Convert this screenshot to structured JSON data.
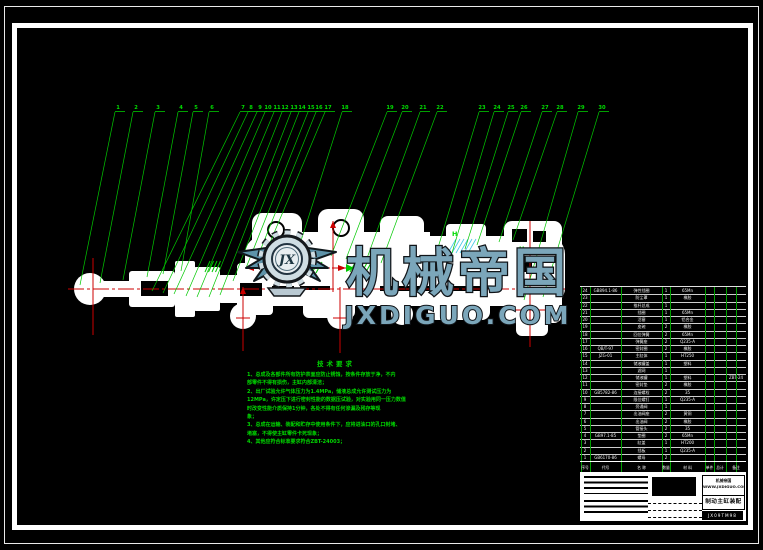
{
  "colors": {
    "line_green": "#00c800",
    "text_green": "#00d800",
    "centerline_red": "#cc0000",
    "hatch_cyan": "#45c8e6",
    "table_green": "#00a000",
    "watermark_fill": "#7ba6ba",
    "watermark_outline": "#101418",
    "drawing_white": "#ffffff"
  },
  "watermark": {
    "brand": "机械帝国",
    "site": "JXDIGUO.COM",
    "monogram": "JX"
  },
  "balloons": {
    "labels": [
      "1",
      "2",
      "3",
      "4",
      "5",
      "6",
      "7",
      "8",
      "9",
      "10",
      "11",
      "12",
      "13",
      "14",
      "15",
      "16",
      "17",
      "18",
      "19",
      "20",
      "21",
      "22",
      "23",
      "24",
      "25",
      "26",
      "27",
      "28",
      "29",
      "30"
    ]
  },
  "section_labels": [
    "H",
    "H"
  ],
  "notes": {
    "title": "技术要求",
    "lines": [
      "1、总成及各部件所有防护表面应防止锈蚀，按条件存放于净，不内",
      "部零件不得有损伤，主缸内部清洁；",
      "2、出厂试验允许气体压力为1.4MPa，储液总成允许测试压力为",
      "12MPa，许定压下进行密封性能的数据压试验，对实验用同一压力数值",
      "时改变性能介质保持1分钟，各处不得有任何渗漏及残存等现",
      "象；",
      "3、总成在运输、装配和贮存中使用条件下，应将进油口的孔口封堵、",
      "堵塞，不得使主缸零件卡死现象；",
      "4、其他应符合标准要求符合ZBT-24003；"
    ]
  },
  "bom": {
    "headers": [
      "序号",
      "代号",
      "名  称",
      "数量",
      "材  料",
      "单件",
      "总计",
      "备注"
    ],
    "rows": [
      [
        "24",
        "GB894.1-86",
        "弹性挡圈",
        "1",
        "65Mn",
        ""
      ],
      [
        "23",
        "",
        "防尘罩",
        "1",
        "橡胶",
        ""
      ],
      [
        "22",
        "",
        "推杆总成",
        "1",
        "",
        ""
      ],
      [
        "21",
        "",
        "挡圈",
        "1",
        "65Mn",
        ""
      ],
      [
        "20",
        "",
        "活塞",
        "1",
        "铝合金",
        ""
      ],
      [
        "19",
        "",
        "皮碗",
        "2",
        "橡胶",
        ""
      ],
      [
        "18",
        "",
        "回位弹簧",
        "2",
        "65Mn",
        ""
      ],
      [
        "17",
        "",
        "弹簧座",
        "2",
        "Q235-A",
        ""
      ],
      [
        "16",
        "QB/T-97",
        "密封圈",
        "2",
        "橡胶",
        ""
      ],
      [
        "15",
        "JZG-01",
        "主缸体",
        "1",
        "HT250",
        ""
      ],
      [
        "14",
        "",
        "储液罐盖",
        "1",
        "塑料",
        ""
      ],
      [
        "13",
        "",
        "滤网",
        "1",
        "",
        ""
      ],
      [
        "12",
        "",
        "储液罐",
        "1",
        "塑料",
        "ZBT-24"
      ],
      [
        "11",
        "",
        "密封垫",
        "2",
        "橡胶",
        ""
      ],
      [
        "10",
        "GB5782-86",
        "连接螺栓",
        "2",
        "35",
        ""
      ],
      [
        "9",
        "",
        "限位螺钉",
        "1",
        "Q235-A",
        ""
      ],
      [
        "8",
        "",
        "旁通阀",
        "1",
        "",
        ""
      ],
      [
        "7",
        "",
        "出油阀座",
        "2",
        "黄铜",
        ""
      ],
      [
        "6",
        "",
        "出油阀",
        "2",
        "橡胶",
        ""
      ],
      [
        "5",
        "",
        "管接头",
        "2",
        "35",
        ""
      ],
      [
        "4",
        "GB97.1-85",
        "垫圈",
        "2",
        "65Mn",
        ""
      ],
      [
        "3",
        "",
        "缸盖",
        "1",
        "HT200",
        ""
      ],
      [
        "2",
        "",
        "挡板",
        "1",
        "Q235-A",
        ""
      ],
      [
        "1",
        "GB6170-86",
        "螺母",
        "2",
        "",
        ""
      ]
    ]
  },
  "title_block": {
    "provider_line1": "机械帝国",
    "provider_line2": "WWW.JXDIGUO.COM",
    "drawing_title": "制动主缸装配图",
    "drawing_code": "JX09TM98"
  }
}
